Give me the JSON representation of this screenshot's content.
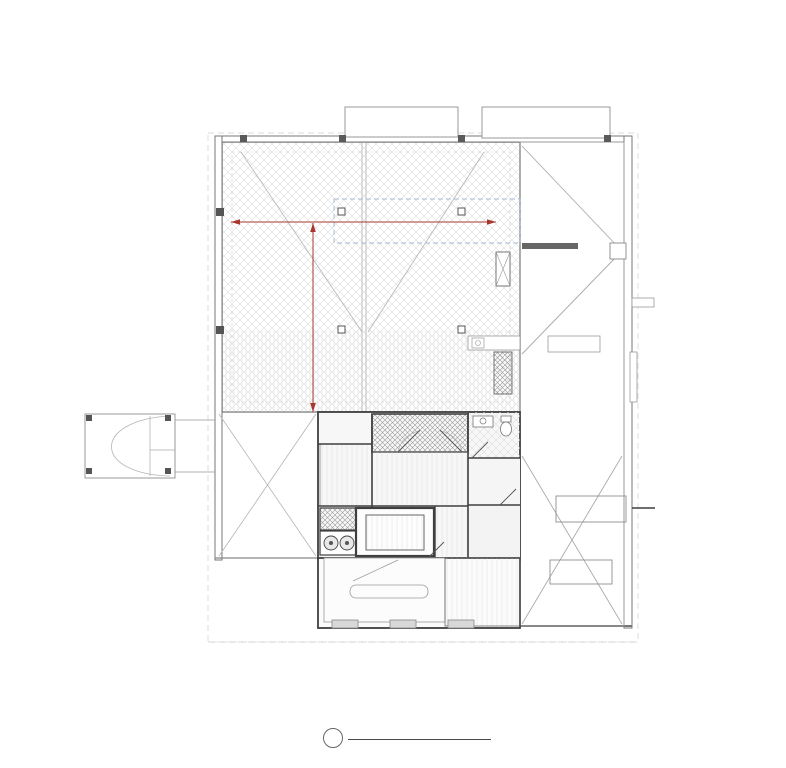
{
  "sheet": {
    "detail_number": "1",
    "sheet_ref": "A1.6",
    "title": "FLOOR PLAN - LEVEL 6 - ROOF DECK",
    "scale": "3/8\" = 1'-0\"",
    "status": "PROPOSED BUILD OUT"
  },
  "grid": {
    "columns": [
      "A.0",
      "A.1",
      "A.9",
      "B.0",
      "B.2",
      "B.3",
      "B.7",
      "C.0",
      "C.1",
      "C.3",
      "C.4",
      "C.7",
      "C.8",
      "D.0"
    ],
    "rows": [
      "1.0",
      "2.0",
      "2.2",
      "3.0",
      "3.2",
      "3.4",
      "3.6",
      "4.0",
      "4.2"
    ],
    "row_special": "3.1"
  },
  "dimensions": {
    "horizontal": "44'-0\"",
    "vertical": "44'-0\""
  },
  "rooms": [
    {
      "name": "EXTERIOR STAIR",
      "tag": "600",
      "ref": ""
    },
    {
      "name": "ROOF DECK PANTRY",
      "tag": "605",
      "ref": "SEE A8.06"
    },
    {
      "name": "FOYER",
      "tag": "601",
      "ref": "SEE A8.06"
    },
    {
      "name": "ROOF DECK WOMEN'S ROOM",
      "tag": "604",
      "ref": "SEE A8.06"
    },
    {
      "name": "VESTIBULE",
      "tag": "603",
      "ref": ""
    },
    {
      "name": "ELEVATOR",
      "tag": "606",
      "ref": ""
    },
    {
      "name": "STAIR ACCESS",
      "tag": "602",
      "ref": ""
    },
    {
      "name": "EGRESS STAIR",
      "tag": "700",
      "ref": ""
    }
  ],
  "finish_tags": [
    "F1",
    "F1",
    "F1"
  ],
  "stair_direction_labels": [
    "DN",
    "DN"
  ],
  "note_lines": [
    "SHOWN FOR INTERIOR FINISHES",
    "ONLY. ALL OTHER ITEMS PROVIDED",
    "IN BASE BUILDING CONSTRUCTION"
  ],
  "colors": {
    "dimension_red": "#a8382e",
    "skylight_blue": "#a9bed4",
    "linework_gray": "#8a8a8a"
  }
}
